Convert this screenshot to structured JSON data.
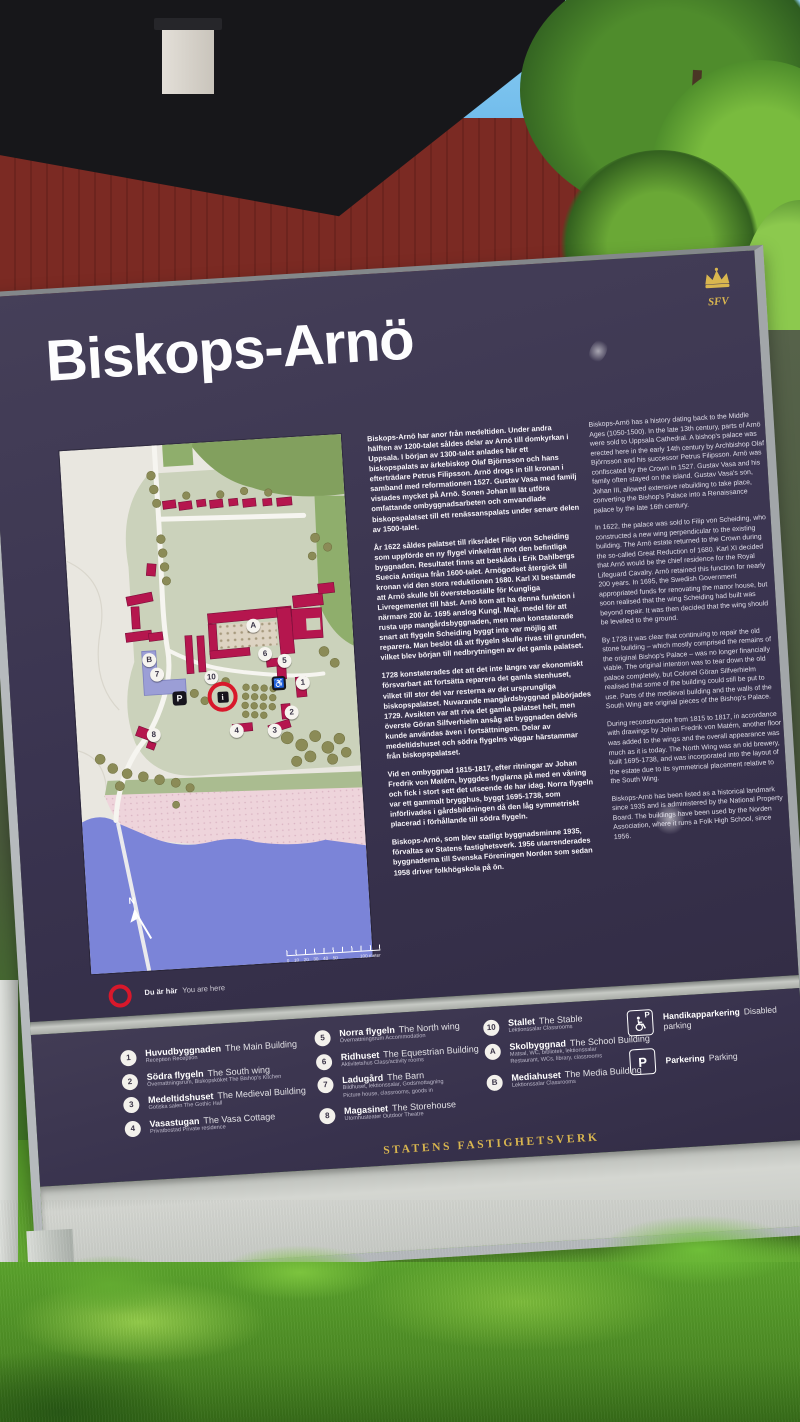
{
  "sign": {
    "title": "Biskops-Arnö",
    "logo": {
      "name": "statens-fastighetsverk-crown",
      "initials": "SFV",
      "color": "#d9b64f"
    },
    "columns": {
      "swedish": [
        "Biskops-Arnö har anor från medeltiden. Under andra hälften av 1200-talet såldes delar av Arnö till domkyrkan i Uppsala. I början av 1300-talet anlades här ett biskopspalats av ärkebiskop Olaf Björnsson och hans efterträdare Petrus Filipsson. Arnö drogs in till kronan i samband med reformationen 1527. Gustav Vasa med familj vistades mycket på Arnö. Sonen Johan III lät utföra omfattande ombyggnadsarbeten och omvandlade biskopspalatset till ett renässanspalats under senare delen av 1500-talet.",
        "År 1622 såldes palatset till riksrådet Filip von Scheiding som uppförde en ny flygel vinkelrätt mot den befintliga byggnaden. Resultatet finns att beskåda i Erik Dahlbergs Suecia Antiqua från 1600-talet. Arnögodset återgick till kronan vid den stora reduktionen 1680. Karl XI bestämde att Arnö skulle bli översteboställe för Kungliga Livregementet till häst. Arnö kom att ha denna funktion i närmare 200 år. 1695 anslog Kungl. Majt. medel för att rusta upp mangårdsbyggnaden, men man konstaterade snart att flygeln Scheiding byggt inte var möjlig att reparera. Man beslöt då att flygeln skulle rivas till grunden, vilket blev början till nedbrytningen av det gamla palatset.",
        "1728 konstaterades det att det inte längre var ekonomiskt försvarbart att fortsätta reparera det gamla stenhuset, vilket till stor del var resterna av det ursprungliga biskopspalatset. Nuvarande mangårdsbyggnad påbörjades 1729. Avsikten var att riva det gamla palatset helt, men överste Göran Silfverhielm ansåg att byggnaden delvis kunde användas även i fortsättningen. Delar av medeltidshuset och södra flygelns väggar härstammar från biskopspalatset.",
        "Vid en ombyggnad 1815-1817, efter ritningar av Johan Fredrik von Matérn, byggdes flyglarna på med en våning och fick i stort sett det utseende de har idag. Norra flygeln var ett gammalt brygghus, byggt 1695-1738, som införlivades i gårdsbildningen då den låg symmetriskt placerad i förhållande till södra flygeln.",
        "Biskops-Arnö, som blev statligt byggnadsminne 1935, förvaltas av Statens fastighetsverk. 1956 utarrenderades byggnaderna till Svenska Föreningen Norden som sedan 1958 driver folkhögskola på ön."
      ],
      "english": [
        "Biskops-Arnö has a history dating back to the Middle Ages (1050-1500). In the late 13th century, parts of Arnö were sold to Uppsala Cathedral. A bishop's palace was erected here in the early 14th century by Archbishop Olaf Björnsson and his successor Petrus Filipsson. Arnö was confiscated by the Crown in 1527. Gustav Vasa and his family often stayed on the island. Gustav Vasa's son, Johan III, allowed extensive rebuilding to take place, converting the Bishop's Palace into a Renaissance palace by the late 16th century.",
        "In 1622, the palace was sold to Filip von Scheiding, who constructed a new wing perpendicular to the existing building. The Arnö estate returned to the Crown during the so-called Great Reduction of 1680. Karl XI decided that Arnö would be the chief residence for the Royal Lifeguard Cavalry. Arnö retained this function for nearly 200 years. In 1695, the Swedish Government appropriated funds for renovating the manor house, but soon realised that the wing Scheiding had built was beyond repair. It was then decided that the wing should be levelled to the ground.",
        "By 1728 it was clear that continuing to repair the old stone building – which mostly comprised the remains of the original Bishop's Palace – was no longer financially viable. The original intention was to tear down the old palace completely, but Colonel Göran Silfverhielm realised that some of the building could still be put to use. Parts of the medieval building and the walls of the South Wing are original pieces of the Bishop's Palace.",
        "During reconstruction from 1815 to 1817, in accordance with drawings by Johan Fredrik von Matérn, another floor was added to the wings and the overall appearance was much as it is today. The North Wing was an old brewery, built 1695-1738, and was incorporated into the layout of the estate due to its symmetrical placement relative to the South Wing.",
        "Biskops-Arnö has been listed as a historical landmark since 1935 and is administered by the National Property Board. The buildings have been used by the Norden Association, where it runs a Folk High School, since 1956."
      ]
    },
    "map": {
      "you_are_here": {
        "sv": "Du är här",
        "en": "You are here"
      },
      "compass_label": "N",
      "scale": {
        "ticks": [
          "0",
          "10",
          "20",
          "30",
          "40",
          "50"
        ],
        "end_label": "100 meter"
      },
      "markers": [
        {
          "label": "B",
          "type": "circle",
          "x": 77,
          "y": 214
        },
        {
          "label": "7",
          "type": "circle",
          "x": 84,
          "y": 229
        },
        {
          "label": "8",
          "type": "circle",
          "x": 77,
          "y": 289
        },
        {
          "label": "A",
          "type": "circle",
          "x": 183,
          "y": 186
        },
        {
          "label": "6",
          "type": "circle",
          "x": 193,
          "y": 215
        },
        {
          "label": "5",
          "type": "circle",
          "x": 212,
          "y": 223
        },
        {
          "label": "1",
          "type": "circle",
          "x": 229,
          "y": 246
        },
        {
          "label": "2",
          "type": "circle",
          "x": 216,
          "y": 275
        },
        {
          "label": "3",
          "type": "circle",
          "x": 198,
          "y": 292
        },
        {
          "label": "4",
          "type": "circle",
          "x": 160,
          "y": 290
        },
        {
          "label": "10",
          "type": "circle",
          "x": 138,
          "y": 235
        },
        {
          "label": "P",
          "type": "plate",
          "x": 105,
          "y": 254
        },
        {
          "label": "♿",
          "type": "plate",
          "x": 205,
          "y": 245
        },
        {
          "label": "i",
          "type": "info",
          "x": 144,
          "y": 251
        }
      ]
    },
    "legend": {
      "col1": [
        {
          "badge": "1",
          "sv": "Huvudbyggnaden",
          "en": "The Main Building",
          "sub": "Reception  Reception"
        },
        {
          "badge": "2",
          "sv": "Södra flygeln",
          "en": "The South wing",
          "sub": "Övernattningsrum, Biskopsköket  The Bishop's Kitchen"
        },
        {
          "badge": "3",
          "sv": "Medeltidshuset",
          "en": "The Medieval Building",
          "sub": "Gotiska salen  The Gothic Hall"
        },
        {
          "badge": "4",
          "sv": "Vasastugan",
          "en": "The Vasa Cottage",
          "sub": "Privatbostad  Private residence"
        }
      ],
      "col2": [
        {
          "badge": "5",
          "sv": "Norra flygeln",
          "en": "The North wing",
          "sub": "Övernattningsrum  Accommodation"
        },
        {
          "badge": "6",
          "sv": "Ridhuset",
          "en": "The Equestrian Building",
          "sub": "Aktivitetshus  Class/activity rooms"
        },
        {
          "badge": "7",
          "sv": "Ladugård",
          "en": "The Barn",
          "sub": "Bildhuset, lektionssalar, Godsmottagning\nPicture house, classrooms, goods in"
        },
        {
          "badge": "8",
          "sv": "Magasinet",
          "en": "The Storehouse",
          "sub": "Utomhusteater  Outdoor Theatre"
        }
      ],
      "col3": [
        {
          "badge": "10",
          "sv": "Stallet",
          "en": "The Stable",
          "sub": "Lektionssalar  Classrooms"
        },
        {
          "badge": "A",
          "sv": "Skolbyggnad",
          "en": "The School Building",
          "sub": "Matsal, WC, bibliotek, lektionssalar\nRestaurant, WCs, library, classrooms"
        },
        {
          "badge": "B",
          "sv": "Mediahuset",
          "en": "The Media Building",
          "sub": "Lektionssalar  Classrooms"
        }
      ],
      "parking": {
        "disabled": {
          "sv": "Handikapparkering",
          "en": "Disabled parking"
        },
        "standard": {
          "sv": "Parkering",
          "en": "Parking"
        }
      },
      "footer": "STATENS FASTIGHETSVERK"
    },
    "colors": {
      "panel": "#3a3450",
      "accent_gold": "#d9b64f",
      "building_red": "#b5164e",
      "water_blue": "#7b84d8",
      "marker_red": "#d8182b"
    }
  }
}
